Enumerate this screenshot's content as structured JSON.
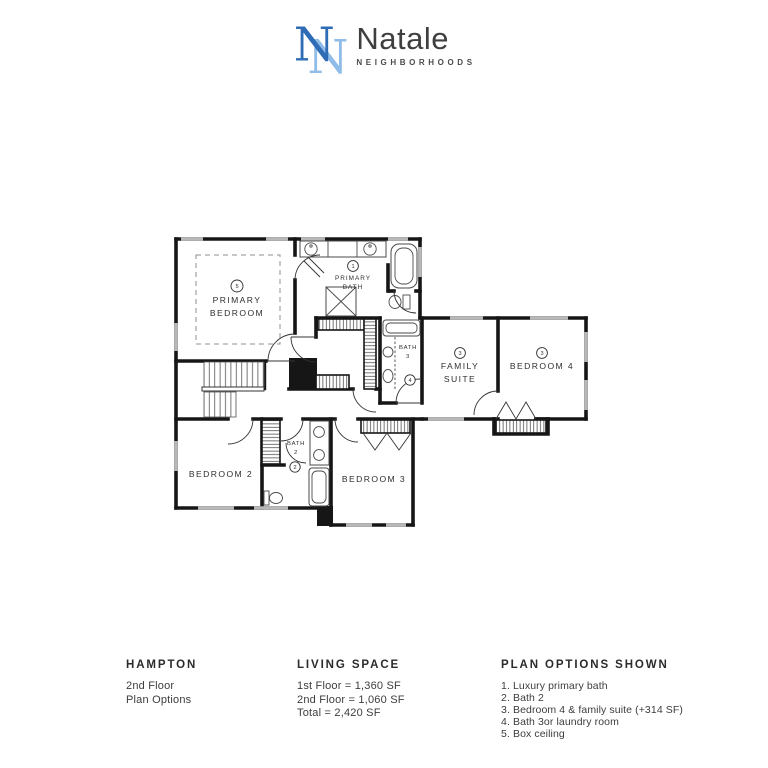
{
  "logo": {
    "monogram": "N",
    "brand": "Natale",
    "tagline": "NEIGHBORHOODS"
  },
  "colors": {
    "brand_dark_blue": "#2e6cb5",
    "brand_light_blue": "#8fbce8",
    "text_dark": "#3d3d3d",
    "wall_black": "#161616",
    "window_gray": "#b8b8b8"
  },
  "floor_plan": {
    "rooms": {
      "primary_bedroom": {
        "option": "5",
        "line1": "PRIMARY",
        "line2": "BEDROOM"
      },
      "primary_bath": {
        "option": "1",
        "line1": "PRIMARY",
        "line2": "BATH"
      },
      "family_suite": {
        "option": "3",
        "line1": "FAMILY",
        "line2": "SUITE"
      },
      "bedroom_4": {
        "option": "3",
        "label": "BEDROOM 4"
      },
      "bath_3": {
        "option": "4",
        "line1": "BATH",
        "line2": "3"
      },
      "bedroom_2": {
        "label": "BEDROOM 2"
      },
      "bath_2": {
        "option": "2",
        "line1": "BATH",
        "line2": "2"
      },
      "bedroom_3": {
        "label": "BEDROOM 3"
      }
    }
  },
  "footer": {
    "model": {
      "title": "HAMPTON",
      "lines": [
        "2nd Floor",
        "Plan Options"
      ]
    },
    "living_space": {
      "title": "LIVING SPACE",
      "lines": [
        "1st Floor = 1,360 SF",
        "2nd Floor = 1,060 SF",
        "Total = 2,420 SF"
      ]
    },
    "plan_options": {
      "title": "PLAN OPTIONS SHOWN",
      "items": [
        "1. Luxury primary bath",
        "2. Bath 2",
        "3. Bedroom 4 & family suite (+314 SF)",
        "4. Bath 3or laundry room",
        "5. Box ceiling"
      ]
    }
  }
}
